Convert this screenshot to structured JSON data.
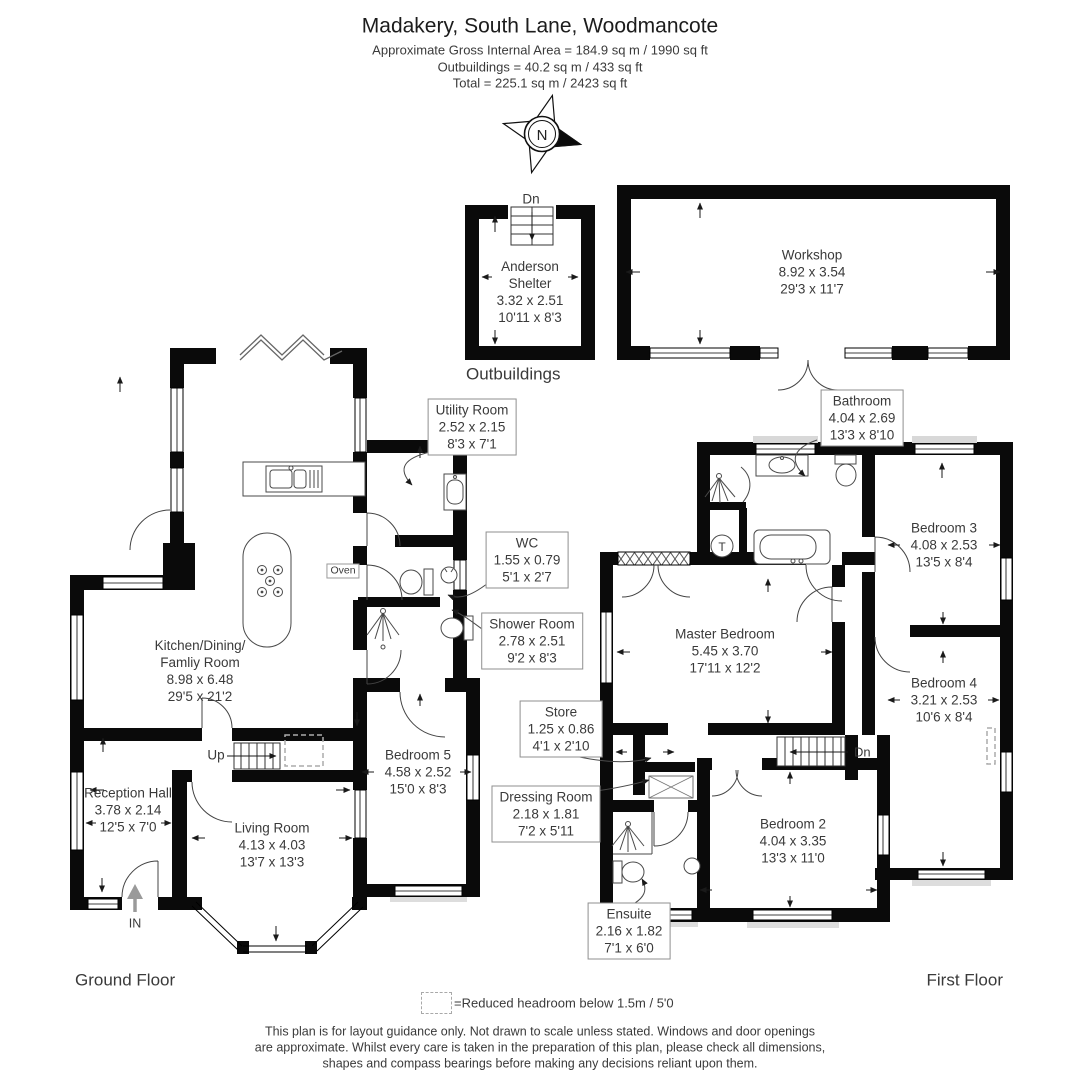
{
  "header": {
    "title": "Madakery, South Lane, Woodmancote",
    "area_line": "Approximate Gross Internal Area = 184.9 sq m / 1990 sq ft",
    "outbuildings_line": "Outbuildings = 40.2 sq m / 433 sq ft",
    "total_line": "Total = 225.1 sq m / 2423 sq ft"
  },
  "compass": {
    "north_label": "N"
  },
  "floor_labels": {
    "outbuildings": "Outbuildings",
    "ground_floor": "Ground Floor",
    "first_floor": "First Floor"
  },
  "annotations": {
    "outbuilding_stairs_down": "Dn",
    "stairs_up": "Up",
    "stairs_down": "Dn",
    "entrance": "IN",
    "oven": "Oven",
    "tank": "T"
  },
  "rooms": {
    "anderson_shelter": {
      "name_line1": "Anderson",
      "name_line2": "Shelter",
      "metric": "3.32 x 2.51",
      "imperial": "10'11 x 8'3"
    },
    "workshop": {
      "name": "Workshop",
      "metric": "8.92 x 3.54",
      "imperial": "29'3 x 11'7"
    },
    "utility_room": {
      "name": "Utility Room",
      "metric": "2.52 x 2.15",
      "imperial": "8'3 x 7'1"
    },
    "wc": {
      "name": "WC",
      "metric": "1.55 x 0.79",
      "imperial": "5'1 x 2'7"
    },
    "shower_room": {
      "name": "Shower Room",
      "metric": "2.78 x 2.51",
      "imperial": "9'2 x 8'3"
    },
    "kitchen": {
      "name_line1": "Kitchen/Dining/",
      "name_line2": "Famliy Room",
      "metric": "8.98 x 6.48",
      "imperial": "29'5 x 21'2"
    },
    "bedroom5": {
      "name": "Bedroom 5",
      "metric": "4.58 x 2.52",
      "imperial": "15'0 x 8'3"
    },
    "reception_hall": {
      "name": "Reception Hall",
      "metric": "3.78 x 2.14",
      "imperial": "12'5 x 7'0"
    },
    "living_room": {
      "name": "Living Room",
      "metric": "4.13 x 4.03",
      "imperial": "13'7 x 13'3"
    },
    "bathroom": {
      "name": "Bathroom",
      "metric": "4.04 x 2.69",
      "imperial": "13'3 x 8'10"
    },
    "bedroom3": {
      "name": "Bedroom 3",
      "metric": "4.08 x 2.53",
      "imperial": "13'5 x 8'4"
    },
    "master_bedroom": {
      "name": "Master Bedroom",
      "metric": "5.45 x 3.70",
      "imperial": "17'11 x 12'2"
    },
    "bedroom4": {
      "name": "Bedroom 4",
      "metric": "3.21 x 2.53",
      "imperial": "10'6 x 8'4"
    },
    "store": {
      "name": "Store",
      "metric": "1.25 x 0.86",
      "imperial": "4'1 x 2'10"
    },
    "dressing_room": {
      "name": "Dressing Room",
      "metric": "2.18 x 1.81",
      "imperial": "7'2 x 5'11"
    },
    "bedroom2": {
      "name": "Bedroom 2",
      "metric": "4.04 x 3.35",
      "imperial": "13'3 x 11'0"
    },
    "ensuite": {
      "name": "Ensuite",
      "metric": "2.16 x 1.82",
      "imperial": "7'1 x 6'0"
    }
  },
  "legend": {
    "reduced_headroom": "=Reduced headroom below 1.5m / 5'0"
  },
  "disclaimer": {
    "line1": "This plan is for layout guidance only. Not drawn to scale unless stated. Windows and door openings",
    "line2": "are approximate. Whilst every care is taken in the preparation of this plan, please check all dimensions,",
    "line3": "shapes and compass bearings before making any decisions reliant upon them."
  },
  "colors": {
    "wall": "#0a0a0a",
    "text": "#3a3a3a",
    "accent_gray": "#9a9a9a"
  }
}
